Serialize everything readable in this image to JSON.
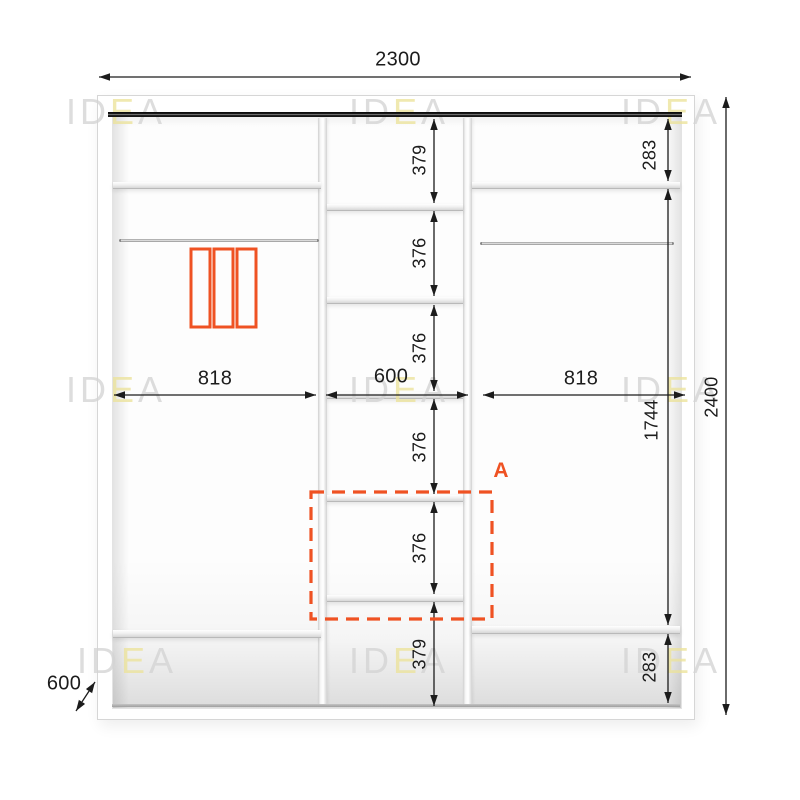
{
  "watermark": {
    "pre": "ID",
    "mid": "E",
    "post": "A"
  },
  "dimensions": {
    "total_width": "2300",
    "total_height": "2400",
    "depth": "600",
    "left_section_width": "818",
    "middle_section_width": "600",
    "right_section_width": "818",
    "middle_shelf_heights": [
      "379",
      "376",
      "376",
      "376",
      "376",
      "379"
    ],
    "right_top_shelf_height": "283",
    "right_hanging_height": "1744",
    "right_bottom_shelf_height": "283"
  },
  "labels": {
    "highlighted_section": "A"
  },
  "icons": {
    "hanging_clothes_icon": "three-vertical-rectangles",
    "section_highlight": "orange-dashed-outline"
  },
  "colors": {
    "accent": "#EF5223",
    "dimension_lines": "#1C1C1C",
    "watermark_gray": "#D4D4D4",
    "watermark_yellow": "#ECE39B",
    "top_rail": "#111111"
  }
}
